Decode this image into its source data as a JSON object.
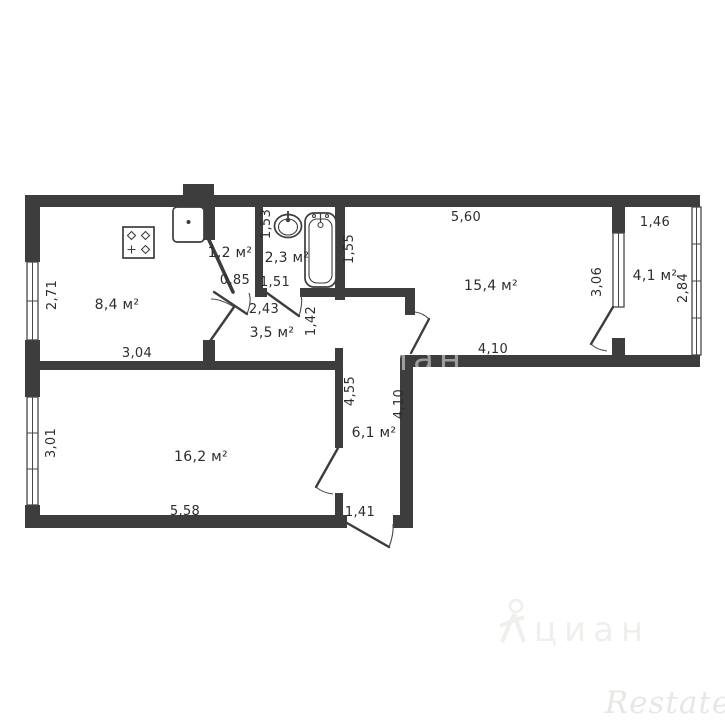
{
  "floor_plan": {
    "type": "apartment-floor-plan",
    "area_unit": "м²",
    "colors": {
      "wall": "#3d3d3d",
      "text": "#2d2d2d",
      "background": "#ffffff"
    },
    "rooms": [
      {
        "name": "kitchen",
        "area": "8,4 м²",
        "dims": {
          "height": "2,71",
          "width": "3,04"
        }
      },
      {
        "name": "storage",
        "area": "1,2 м²",
        "dims": {
          "width": "0,85"
        }
      },
      {
        "name": "bathroom",
        "area": "2,3 м²",
        "dims": {
          "height": "1,53",
          "width": "1,51"
        }
      },
      {
        "name": "hallway",
        "area": "3,5 м²",
        "dims": {
          "width": "2,43",
          "height": "1,42"
        }
      },
      {
        "name": "living_room",
        "area": "15,4 м²",
        "dims": {
          "top_width": "5,60",
          "bottom_width": "4,10",
          "left_height": "1,55",
          "right_height": "3,06"
        }
      },
      {
        "name": "balcony",
        "area": "4,1 м²",
        "dims": {
          "width": "1,46",
          "height": "2,84"
        }
      },
      {
        "name": "bedroom",
        "area": "16,2 м²",
        "dims": {
          "height": "3,01",
          "width": "5,58"
        }
      },
      {
        "name": "entry_corridor",
        "area": "6,1 м²",
        "dims": {
          "left_height": "4,55",
          "right_height": "4,10",
          "width": "1,41"
        }
      }
    ],
    "fixtures": [
      "stove",
      "kitchen-sink",
      "washbasin",
      "bathtub"
    ]
  },
  "watermarks": {
    "cian": "циан",
    "restate": "Restate"
  }
}
